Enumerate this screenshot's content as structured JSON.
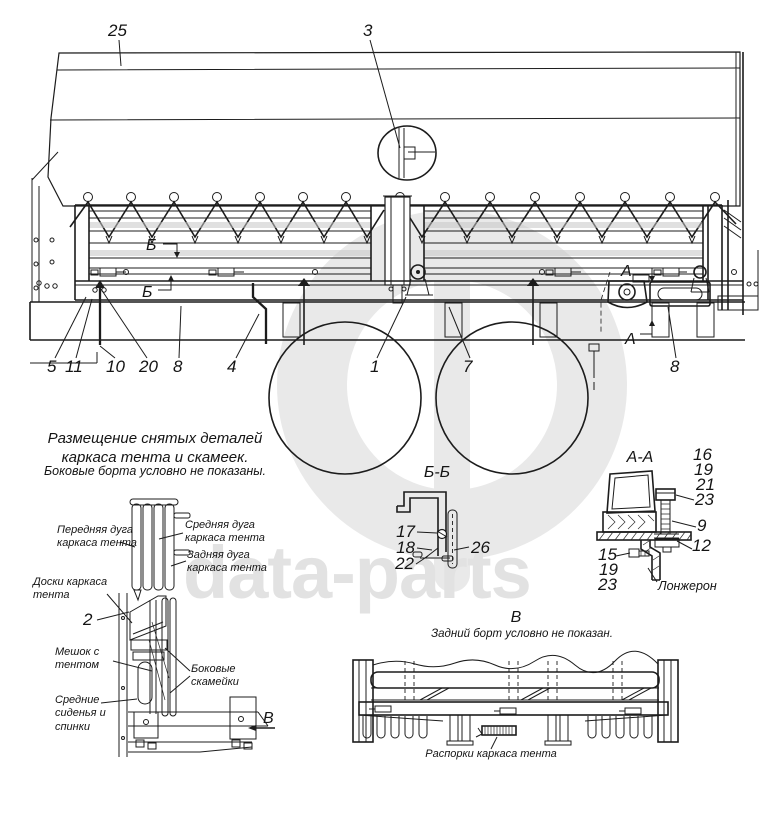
{
  "watermark": {
    "wordmark": "data-parts",
    "color": "#e2e2e2"
  },
  "main_view": {
    "callouts": {
      "c25": "25",
      "c3": "3",
      "c5": "5",
      "c11": "11",
      "c10": "10",
      "c20": "20",
      "c8_left": "8",
      "c4": "4",
      "c1": "1",
      "c7": "7",
      "c8_right": "8"
    },
    "section_marks": {
      "b_upper": "Б",
      "b_lower": "Б",
      "a_upper": "А",
      "a_lower": "А"
    }
  },
  "storage_note": {
    "title": "Размещение снятых деталей каркаса тента и скамеек.",
    "subtitle": "Боковые борта условно не показаны."
  },
  "storage_view": {
    "labels": {
      "front_arc": "Передняя дуга каркаса тента",
      "middle_arc": "Средняя дуга каркаса тента",
      "rear_arc": "Задняя дуга каркаса тента",
      "boards": "Доски каркаса тента",
      "bag": "Мешок с тентом",
      "side_benches": "Боковые скамейки",
      "middle_seats": "Средние сиденья и спинки"
    },
    "callout_2": "2",
    "view_arrow": "В"
  },
  "section_bb": {
    "title": "Б-Б",
    "callouts": {
      "c17": "17",
      "c18": "18",
      "c22": "22",
      "c26": "26"
    }
  },
  "section_aa": {
    "title": "А-А",
    "callouts": {
      "c16": "16",
      "c19_top": "19",
      "c21": "21",
      "c23_top": "23",
      "c9": "9",
      "c12": "12",
      "c15": "15",
      "c19_bottom": "19",
      "c23_bottom": "23"
    },
    "label_longeron": "Лонжерон"
  },
  "view_v": {
    "title": "В",
    "subtitle": "Задний борт условно не показан.",
    "label_spacers": "Распорки каркаса тента"
  }
}
